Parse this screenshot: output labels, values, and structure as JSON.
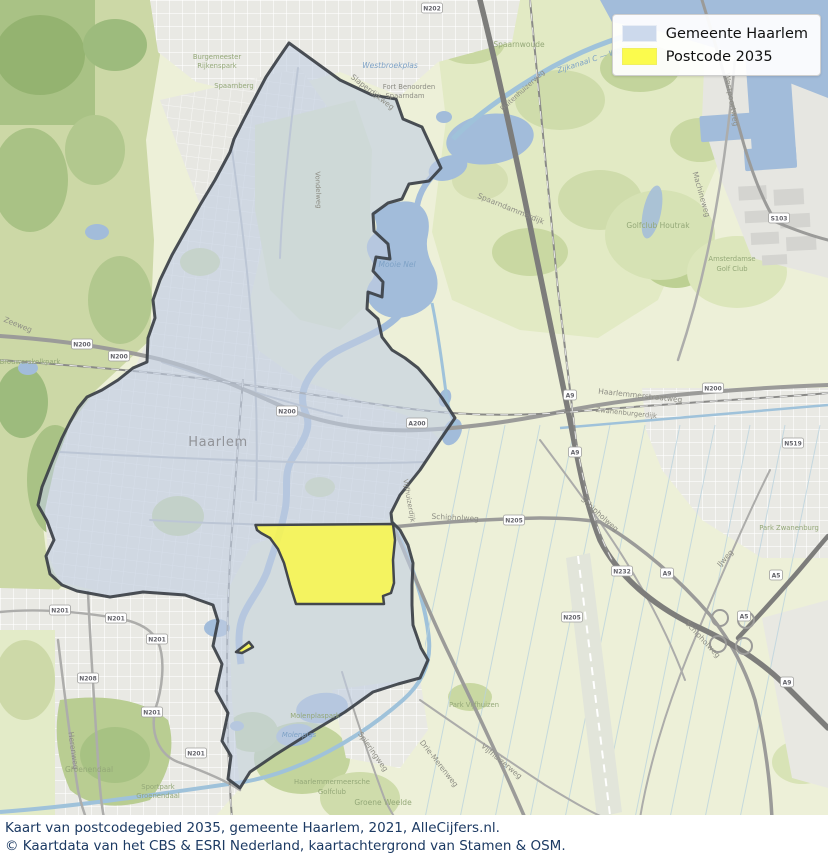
{
  "legend": {
    "items": [
      {
        "label": "Gemeente Haarlem",
        "color": "#ccd9ec"
      },
      {
        "label": "Postcode 2035",
        "color": "#fbfb4d"
      }
    ]
  },
  "caption": {
    "line1": "Kaart van postcodegebied 2035, gemeente Haarlem, 2021, AlleCijfers.nl.",
    "line2": "© Kaartdata van het CBS & ESRI Nederland, kaartachtergrond van Stamen & OSM."
  },
  "map": {
    "colors": {
      "municipality_fill": "#c2cfe2",
      "municipality_stroke": "#3b4046",
      "postcode_fill": "#f8f64e",
      "water": "#a2bcda",
      "field": "#edf0d8",
      "urban": "#e9e9e4"
    },
    "labels": [
      {
        "t": "Haarlem"
      },
      {
        "t": "Spaarnwoude"
      },
      {
        "t": "Westbroekplas"
      },
      {
        "t": "Fort Benoorden"
      },
      {
        "t": "Spaarndam"
      },
      {
        "t": "Slaperdijkweg"
      },
      {
        "t": "Spaarndammerdijk"
      },
      {
        "t": "Zijkanaal C — Weg"
      },
      {
        "t": "Buitenhuizerweg"
      },
      {
        "t": "Mooie Nel"
      },
      {
        "t": "Burgemeester"
      },
      {
        "t": "Rijkenspark"
      },
      {
        "t": "Spaarnberg"
      },
      {
        "t": "Westpoortweg"
      },
      {
        "t": "Machineweg"
      },
      {
        "t": "Golfclub Houtrak"
      },
      {
        "t": "Amsterdamse"
      },
      {
        "t": "Golf Club"
      },
      {
        "t": "Haarlemmerstraatweg"
      },
      {
        "t": "Zwanenburgerdijk"
      },
      {
        "t": "Schipholweg"
      },
      {
        "t": "Schipholweg"
      },
      {
        "t": "Schipholweg"
      },
      {
        "t": "Vijfhuizerdijk"
      },
      {
        "t": "Vijfhuizerweg"
      },
      {
        "t": "Drie-Merenweg"
      },
      {
        "t": "Spieringweg"
      },
      {
        "t": "Park Vijfhuizen"
      },
      {
        "t": "Groene Weelde"
      },
      {
        "t": "Haarlemmermeersche"
      },
      {
        "t": "Golfclub"
      },
      {
        "t": "Molenplaspark"
      },
      {
        "t": "Molenplas"
      },
      {
        "t": "Park Zwanenburg"
      },
      {
        "t": "Groenendaal"
      },
      {
        "t": "Sportpark"
      },
      {
        "t": "Groenendaal"
      },
      {
        "t": "Herenweg"
      },
      {
        "t": "Vondelweg"
      },
      {
        "t": "Zeeweg"
      },
      {
        "t": "Brouwerskolkpark"
      },
      {
        "t": "IJweg"
      }
    ],
    "shields": [
      {
        "t": "N202"
      },
      {
        "t": "S103"
      },
      {
        "t": "N200"
      },
      {
        "t": "N200"
      },
      {
        "t": "N200"
      },
      {
        "t": "N200"
      },
      {
        "t": "N519"
      },
      {
        "t": "A200"
      },
      {
        "t": "N205"
      },
      {
        "t": "N205"
      },
      {
        "t": "N232"
      },
      {
        "t": "A9"
      },
      {
        "t": "A9"
      },
      {
        "t": "A9"
      },
      {
        "t": "A9"
      },
      {
        "t": "A5"
      },
      {
        "t": "A5"
      },
      {
        "t": "N201"
      },
      {
        "t": "N201"
      },
      {
        "t": "N201"
      },
      {
        "t": "N201"
      },
      {
        "t": "N201"
      },
      {
        "t": "N208"
      }
    ]
  }
}
